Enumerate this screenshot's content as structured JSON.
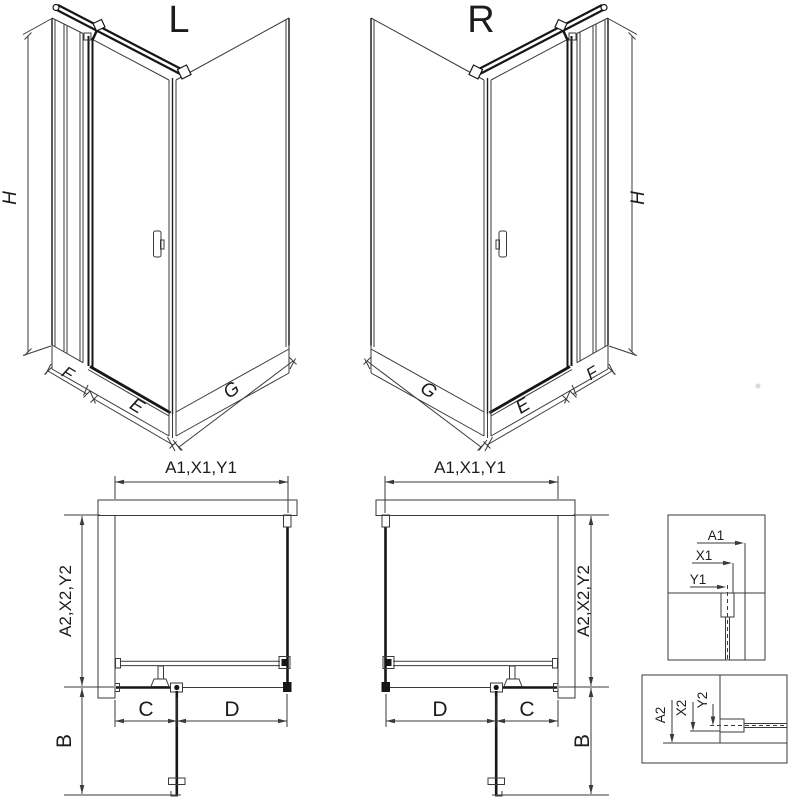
{
  "titles": {
    "left": "L",
    "right": "R"
  },
  "iso": {
    "h": "H",
    "e": "E",
    "f": "F",
    "g": "G"
  },
  "plan": {
    "width": "A1,X1,Y1",
    "depth": "A2,X2,Y2",
    "fixed": "C",
    "door": "D",
    "swing": "B"
  },
  "detail_width": {
    "a": "A1",
    "x": "X1",
    "y": "Y1"
  },
  "detail_depth": {
    "a": "A2",
    "x": "X2",
    "y": "Y2"
  },
  "colors": {
    "line": "#3a3a3a",
    "glass_dark": "#161616",
    "hatch": "#6a6a6a",
    "background": "#ffffff"
  }
}
